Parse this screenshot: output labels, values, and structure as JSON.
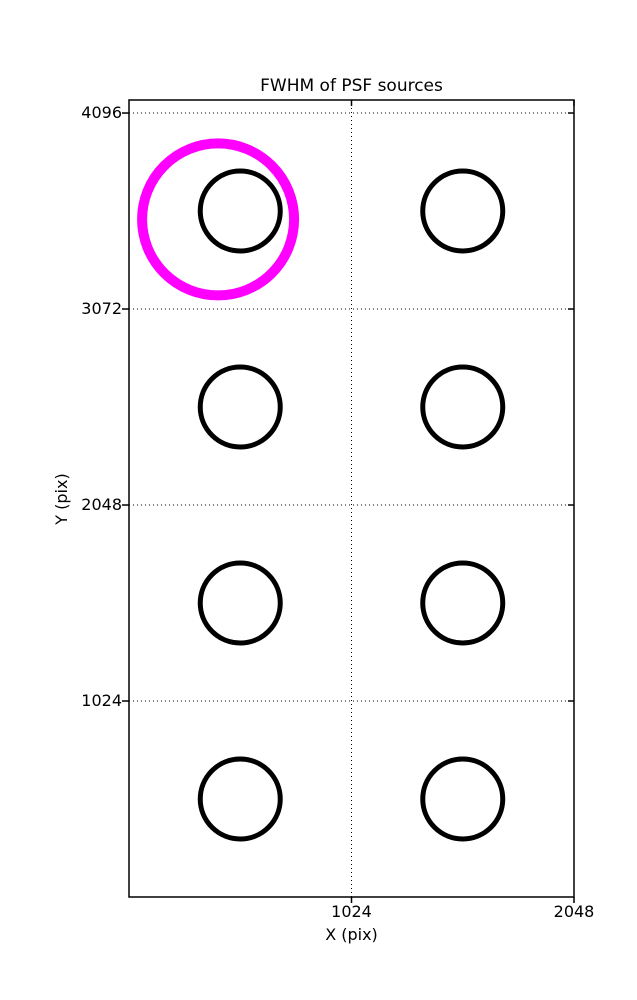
{
  "chart_data": {
    "type": "scatter",
    "title": "FWHM of PSF sources",
    "xlabel": "X (pix)",
    "ylabel": "Y (pix)",
    "xlim": [
      0,
      2048
    ],
    "ylim": [
      0,
      4164
    ],
    "xticks": [
      1024,
      2048
    ],
    "yticks": [
      1024,
      2048,
      3072,
      4096
    ],
    "grid": "dotted",
    "grid_color": "#000000",
    "frame_color": "#000000",
    "background_color": "#ffffff",
    "marker_color": "#000000",
    "marker_stroke_px": 5,
    "sources": [
      {
        "x": 512,
        "y": 3584,
        "marker_radius_px": 40
      },
      {
        "x": 1536,
        "y": 3584,
        "marker_radius_px": 40
      },
      {
        "x": 512,
        "y": 2560,
        "marker_radius_px": 40
      },
      {
        "x": 1536,
        "y": 2560,
        "marker_radius_px": 40
      },
      {
        "x": 512,
        "y": 1536,
        "marker_radius_px": 40
      },
      {
        "x": 1536,
        "y": 1536,
        "marker_radius_px": 40
      },
      {
        "x": 512,
        "y": 512,
        "marker_radius_px": 40
      },
      {
        "x": 1536,
        "y": 512,
        "marker_radius_px": 40
      }
    ],
    "highlight": {
      "x": 410,
      "y": 3540,
      "marker_radius_px": 76,
      "stroke_px": 10,
      "color": "#ff00ff"
    }
  }
}
